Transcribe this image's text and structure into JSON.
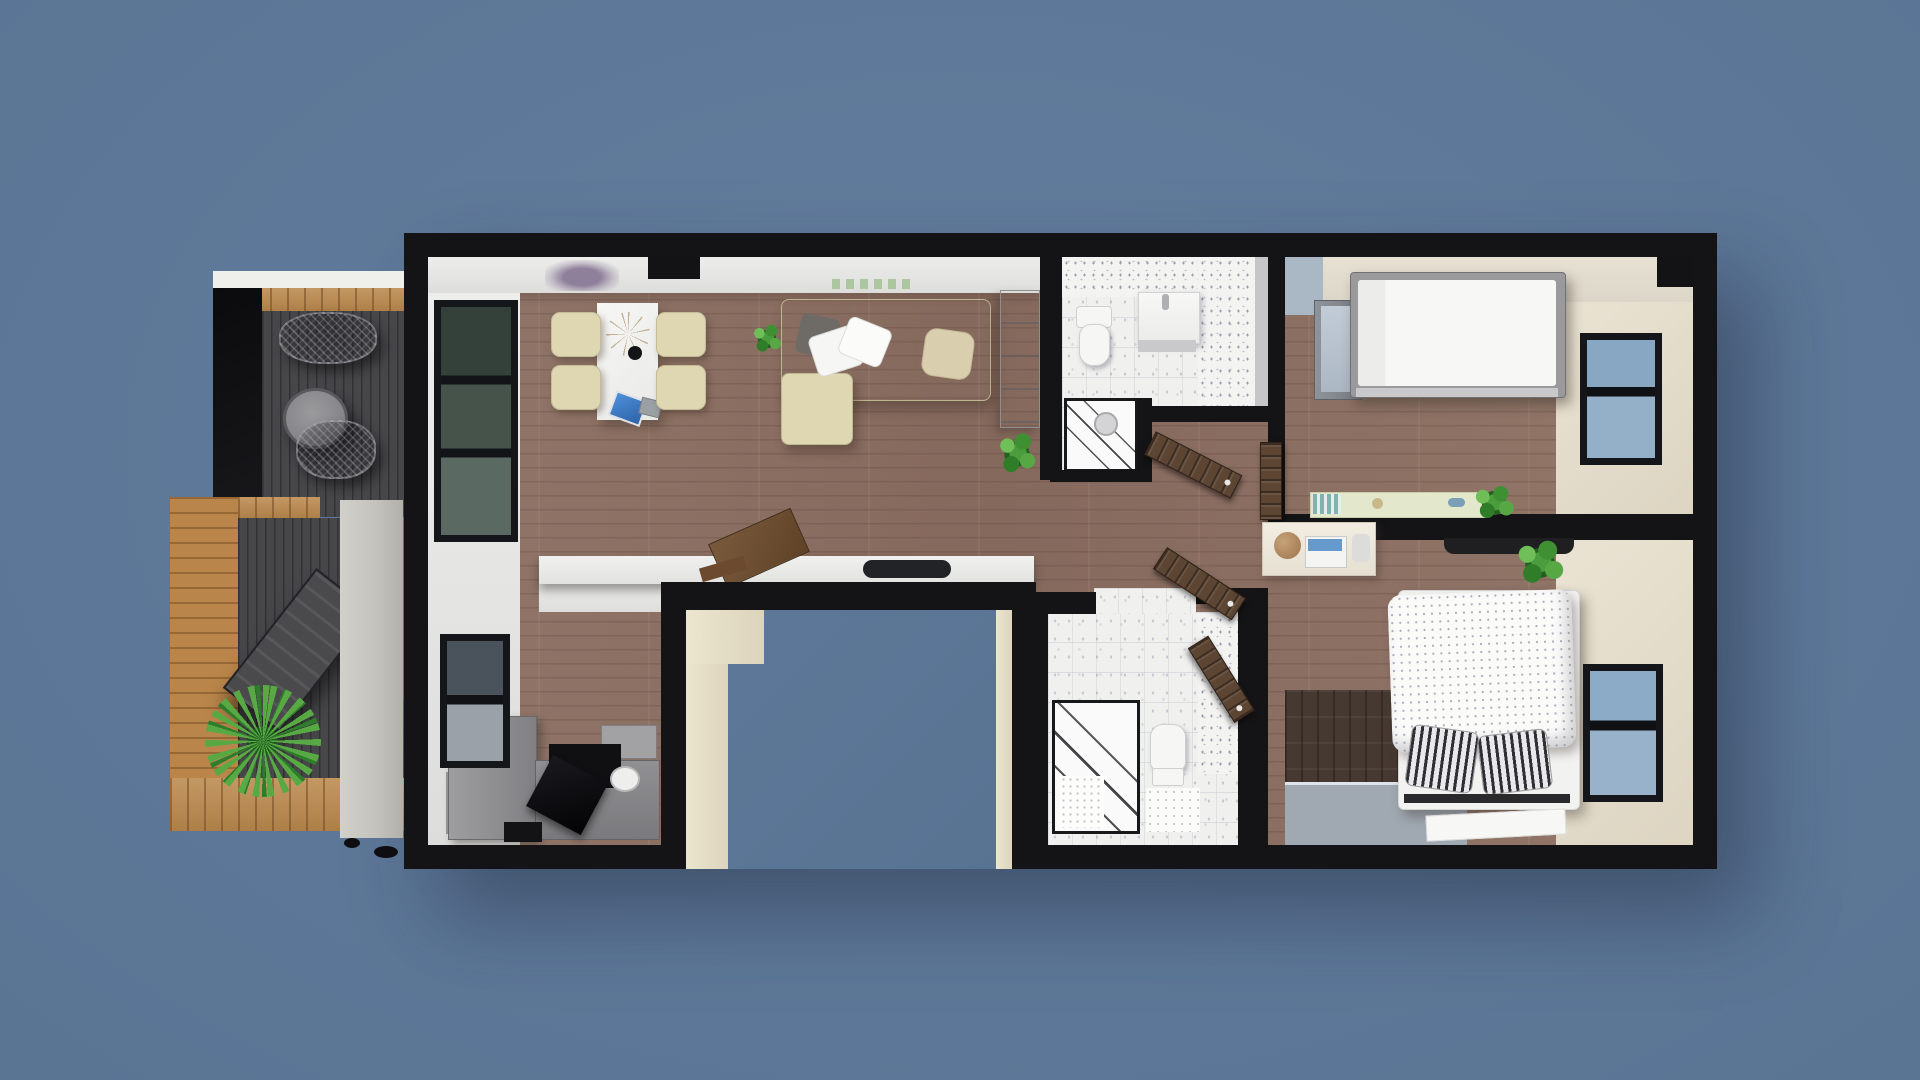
{
  "meta": {
    "description": "3D rendered top-down architectural floor plan of an apartment with a side terrace, shown on a slate-blue backdrop",
    "image_type": "3d-floor-plan-render",
    "view": "top-down",
    "visible_text": "none"
  },
  "palette": {
    "background": "#60789a",
    "walls": "#141416",
    "wood_floor": "#8c7164",
    "dark_wood_rug": "#463931",
    "white_tile": "#f0f0ef",
    "beige_floor": "#e8e1d1",
    "terrace_deck": "#47474a",
    "terrace_wood": "#bc8a4e",
    "cream_furniture": "#ded7b2",
    "door_wood": "#5d4533",
    "window_glass": "#8fb0c9",
    "plant_green": "#4a9c3c",
    "laptop_screen_blue": "#3f82c8",
    "concrete_pillar": "#cdcbc6"
  },
  "rooms": [
    {
      "id": "terrace",
      "label": "Terrace",
      "floor": "dark decking + timber frame",
      "items": [
        "wire chair",
        "wire chair",
        "round side table",
        "sun lounger",
        "palm plant",
        "concrete pillar",
        "roof edge strip"
      ]
    },
    {
      "id": "living-area",
      "label": "Open-plan living / dining / kitchen",
      "floor": "wood planks",
      "items": [
        "dining table",
        "four cream dining chairs",
        "decor branch centerpiece",
        "laptop",
        "L-shaped cream sofa",
        "throw pillows",
        "potted plant",
        "potted plant",
        "tall gray cabinet",
        "breakfast counter",
        "cutting board",
        "serving tray",
        "gray kitchen counters",
        "cooktop",
        "sink",
        "wall art",
        "tall window",
        "window"
      ]
    },
    {
      "id": "bathroom-top",
      "label": "Bathroom (top)",
      "floor": "white tile",
      "items": [
        "toilet",
        "washbasin unit",
        "glass shower cabin"
      ]
    },
    {
      "id": "hallway",
      "label": "Hallway",
      "floor": "wood planks",
      "items": [
        "open wooden door",
        "open wooden door",
        "open wooden door",
        "door leaf against wall"
      ]
    },
    {
      "id": "bedroom-top",
      "label": "Bedroom (top right)",
      "floor": "wood + beige carpet",
      "items": [
        "double bed",
        "mirrored wardrobe",
        "long sideboard with decor",
        "black wall shelf",
        "potted plant",
        "window"
      ]
    },
    {
      "id": "bedroom-bottom",
      "label": "Bedroom (bottom right)",
      "floor": "wood + beige carpet",
      "items": [
        "double bed with dotted duvet",
        "striped pillows",
        "corner desk",
        "laptop",
        "teddy bear",
        "dark wood rug",
        "gray floor mat",
        "white bedside mat",
        "potted plant",
        "window"
      ]
    },
    {
      "id": "bathroom-bottom",
      "label": "Bathroom (bottom)",
      "floor": "white tile",
      "items": [
        "glass shower cabin",
        "toilet",
        "bath mats"
      ]
    },
    {
      "id": "entry-notch",
      "label": "Recessed entrance cut-out",
      "items": [
        "cream reveal walls"
      ]
    }
  ]
}
